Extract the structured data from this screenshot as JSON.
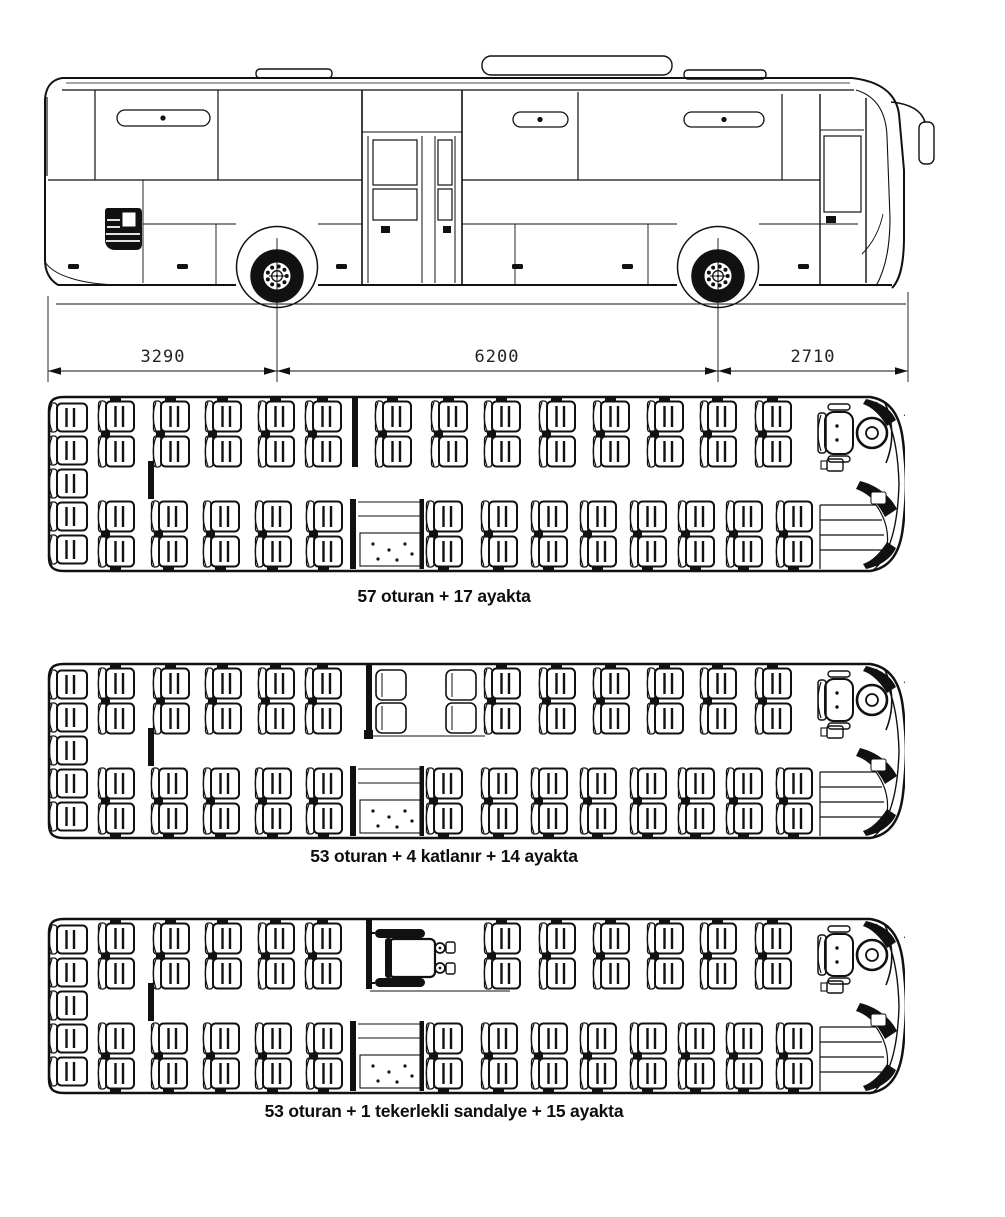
{
  "page": {
    "background": "#ffffff",
    "ink": "#111111",
    "drawing_type": "bus technical drawing with seating layouts"
  },
  "side_view": {
    "name": "bus side elevation",
    "dimensions": [
      {
        "label": "3290",
        "from_x": 48,
        "to_x": 277
      },
      {
        "label": "6200",
        "from_x": 277,
        "to_x": 718
      },
      {
        "label": "2710",
        "from_x": 718,
        "to_x": 908
      }
    ]
  },
  "floor_plans": [
    {
      "caption": "57 oturan + 17 ayakta",
      "seated": 57,
      "standing": 17,
      "folding_seats": 0,
      "wheelchair_spots": 0,
      "layout": {
        "rear_bench_seats": 5,
        "top_columns": [
          55,
          110,
          162,
          215,
          262,
          332,
          388,
          441,
          496,
          550,
          604,
          657,
          712
        ],
        "bottom_columns": [
          55,
          108,
          160,
          212,
          263,
          383,
          438,
          488,
          537,
          587,
          635,
          683,
          733
        ],
        "top_partition_x": 312,
        "folding_columns": [],
        "wheelchair": false
      }
    },
    {
      "caption": "53 oturan + 4 katlanır + 14 ayakta",
      "seated": 53,
      "standing": 14,
      "folding_seats": 4,
      "wheelchair_spots": 0,
      "layout": {
        "rear_bench_seats": 5,
        "top_columns": [
          55,
          110,
          162,
          215,
          262,
          441,
          496,
          550,
          604,
          657,
          712
        ],
        "bottom_columns": [
          55,
          108,
          160,
          212,
          263,
          383,
          438,
          488,
          537,
          587,
          635,
          683,
          733
        ],
        "top_partition_x": 326,
        "folding_columns": [
          336,
          406
        ],
        "wheelchair": false
      }
    },
    {
      "caption": "53 oturan + 1 tekerlekli sandalye + 15 ayakta",
      "seated": 53,
      "standing": 15,
      "folding_seats": 0,
      "wheelchair_spots": 1,
      "layout": {
        "rear_bench_seats": 5,
        "top_columns": [
          55,
          110,
          162,
          215,
          262,
          441,
          496,
          550,
          604,
          657,
          712
        ],
        "bottom_columns": [
          55,
          108,
          160,
          212,
          263,
          383,
          438,
          488,
          537,
          587,
          635,
          683,
          733
        ],
        "top_partition_x": 326,
        "folding_columns": [],
        "wheelchair": true,
        "wheelchair_x": 335
      }
    }
  ]
}
